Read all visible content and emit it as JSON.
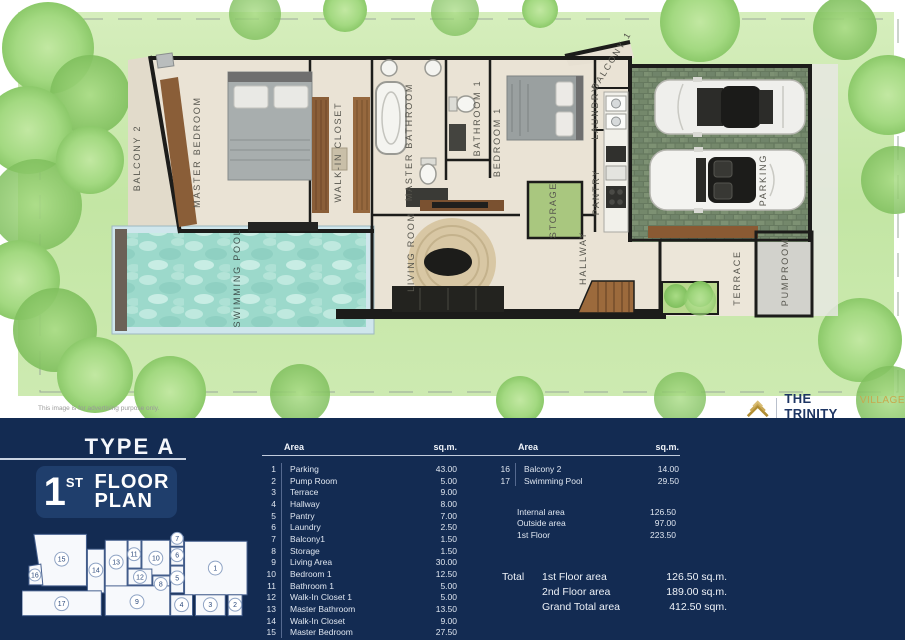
{
  "plan": {
    "labels": {
      "balcony2": "BALCONY 2",
      "master_bedroom": "MASTER BEDROOM",
      "walk_in_closet": "WALK-IN  CLOSET",
      "master_bathroom": "MASTER  BATHROOM",
      "bathroom1": "BATHROOM 1",
      "bedroom1": "BEDROOM 1",
      "laundry": "LAUNDRY",
      "balcony1": "BALCONY 1",
      "pantry": "PANTRY",
      "storage": "STORAGE",
      "living_room": "LIVING ROOM",
      "hallway": "HALLWAY",
      "terrace": "TERRACE",
      "pumproom": "PUMPROOM",
      "parking": "PARKING",
      "swimming_pool": "SWIMMING POOL"
    },
    "disclaimer": "This image is for advertising purpose only."
  },
  "brand": {
    "name": "THE TRINITY",
    "suffix": "VILLAGE",
    "tagline": "BY ANDAMAN ASSET SOLUTION"
  },
  "panel": {
    "type_title": "TYPE A",
    "floor_badge": {
      "number": "1",
      "ordinal": "ST",
      "word1": "FLOOR",
      "word2": "PLAN"
    },
    "table1": {
      "col_area": "Area",
      "col_unit": "sq.m.",
      "rows": [
        {
          "n": "1",
          "name": "Parking",
          "sqm": "43.00"
        },
        {
          "n": "2",
          "name": "Pump Room",
          "sqm": "5.00"
        },
        {
          "n": "3",
          "name": "Terrace",
          "sqm": "9.00"
        },
        {
          "n": "4",
          "name": "Hallway",
          "sqm": "8.00"
        },
        {
          "n": "5",
          "name": "Pantry",
          "sqm": "7.00"
        },
        {
          "n": "6",
          "name": "Laundry",
          "sqm": "2.50"
        },
        {
          "n": "7",
          "name": "Balcony1",
          "sqm": "1.50"
        },
        {
          "n": "8",
          "name": "Storage",
          "sqm": "1.50"
        },
        {
          "n": "9",
          "name": "Living Area",
          "sqm": "30.00"
        },
        {
          "n": "10",
          "name": "Bedroom 1",
          "sqm": "12.50"
        },
        {
          "n": "11",
          "name": "Bathroom 1",
          "sqm": "5.00"
        },
        {
          "n": "12",
          "name": "Walk-In Closet 1",
          "sqm": "5.00"
        },
        {
          "n": "13",
          "name": "Master Bathroom",
          "sqm": "13.50"
        },
        {
          "n": "14",
          "name": "Walk-In Closet",
          "sqm": "9.00"
        },
        {
          "n": "15",
          "name": "Master Bedroom",
          "sqm": "27.50"
        }
      ]
    },
    "table2": {
      "col_area": "Area",
      "col_unit": "sq.m.",
      "rows": [
        {
          "n": "16",
          "name": "Balcony 2",
          "sqm": "14.00"
        },
        {
          "n": "17",
          "name": "Swimming Pool",
          "sqm": "29.50"
        }
      ]
    },
    "summary": [
      {
        "label": "Internal area",
        "value": "126.50"
      },
      {
        "label": "Outside area",
        "value": "97.00"
      },
      {
        "label": "1st Floor",
        "value": "223.50"
      }
    ],
    "totals": {
      "label": "Total",
      "rows": [
        {
          "label": "1st Floor area",
          "value": "126.50 sq.m."
        },
        {
          "label": "2nd Floor area",
          "value": "189.00 sq.m."
        },
        {
          "label": "Grand Total area",
          "value": "412.50 sqm."
        }
      ]
    },
    "minimap_numbers": [
      "1",
      "2",
      "3",
      "4",
      "5",
      "6",
      "7",
      "8",
      "9",
      "10",
      "11",
      "12",
      "13",
      "14",
      "15",
      "16",
      "17"
    ]
  },
  "colors": {
    "panel_bg": "#132b52",
    "badge_bg": "#1f3e6c",
    "accent_gold": "#b08d33",
    "water": "#9cd9cb",
    "grass": "#c3e6a4",
    "floor": "#eae3d5",
    "wall": "#1c1c1a"
  }
}
